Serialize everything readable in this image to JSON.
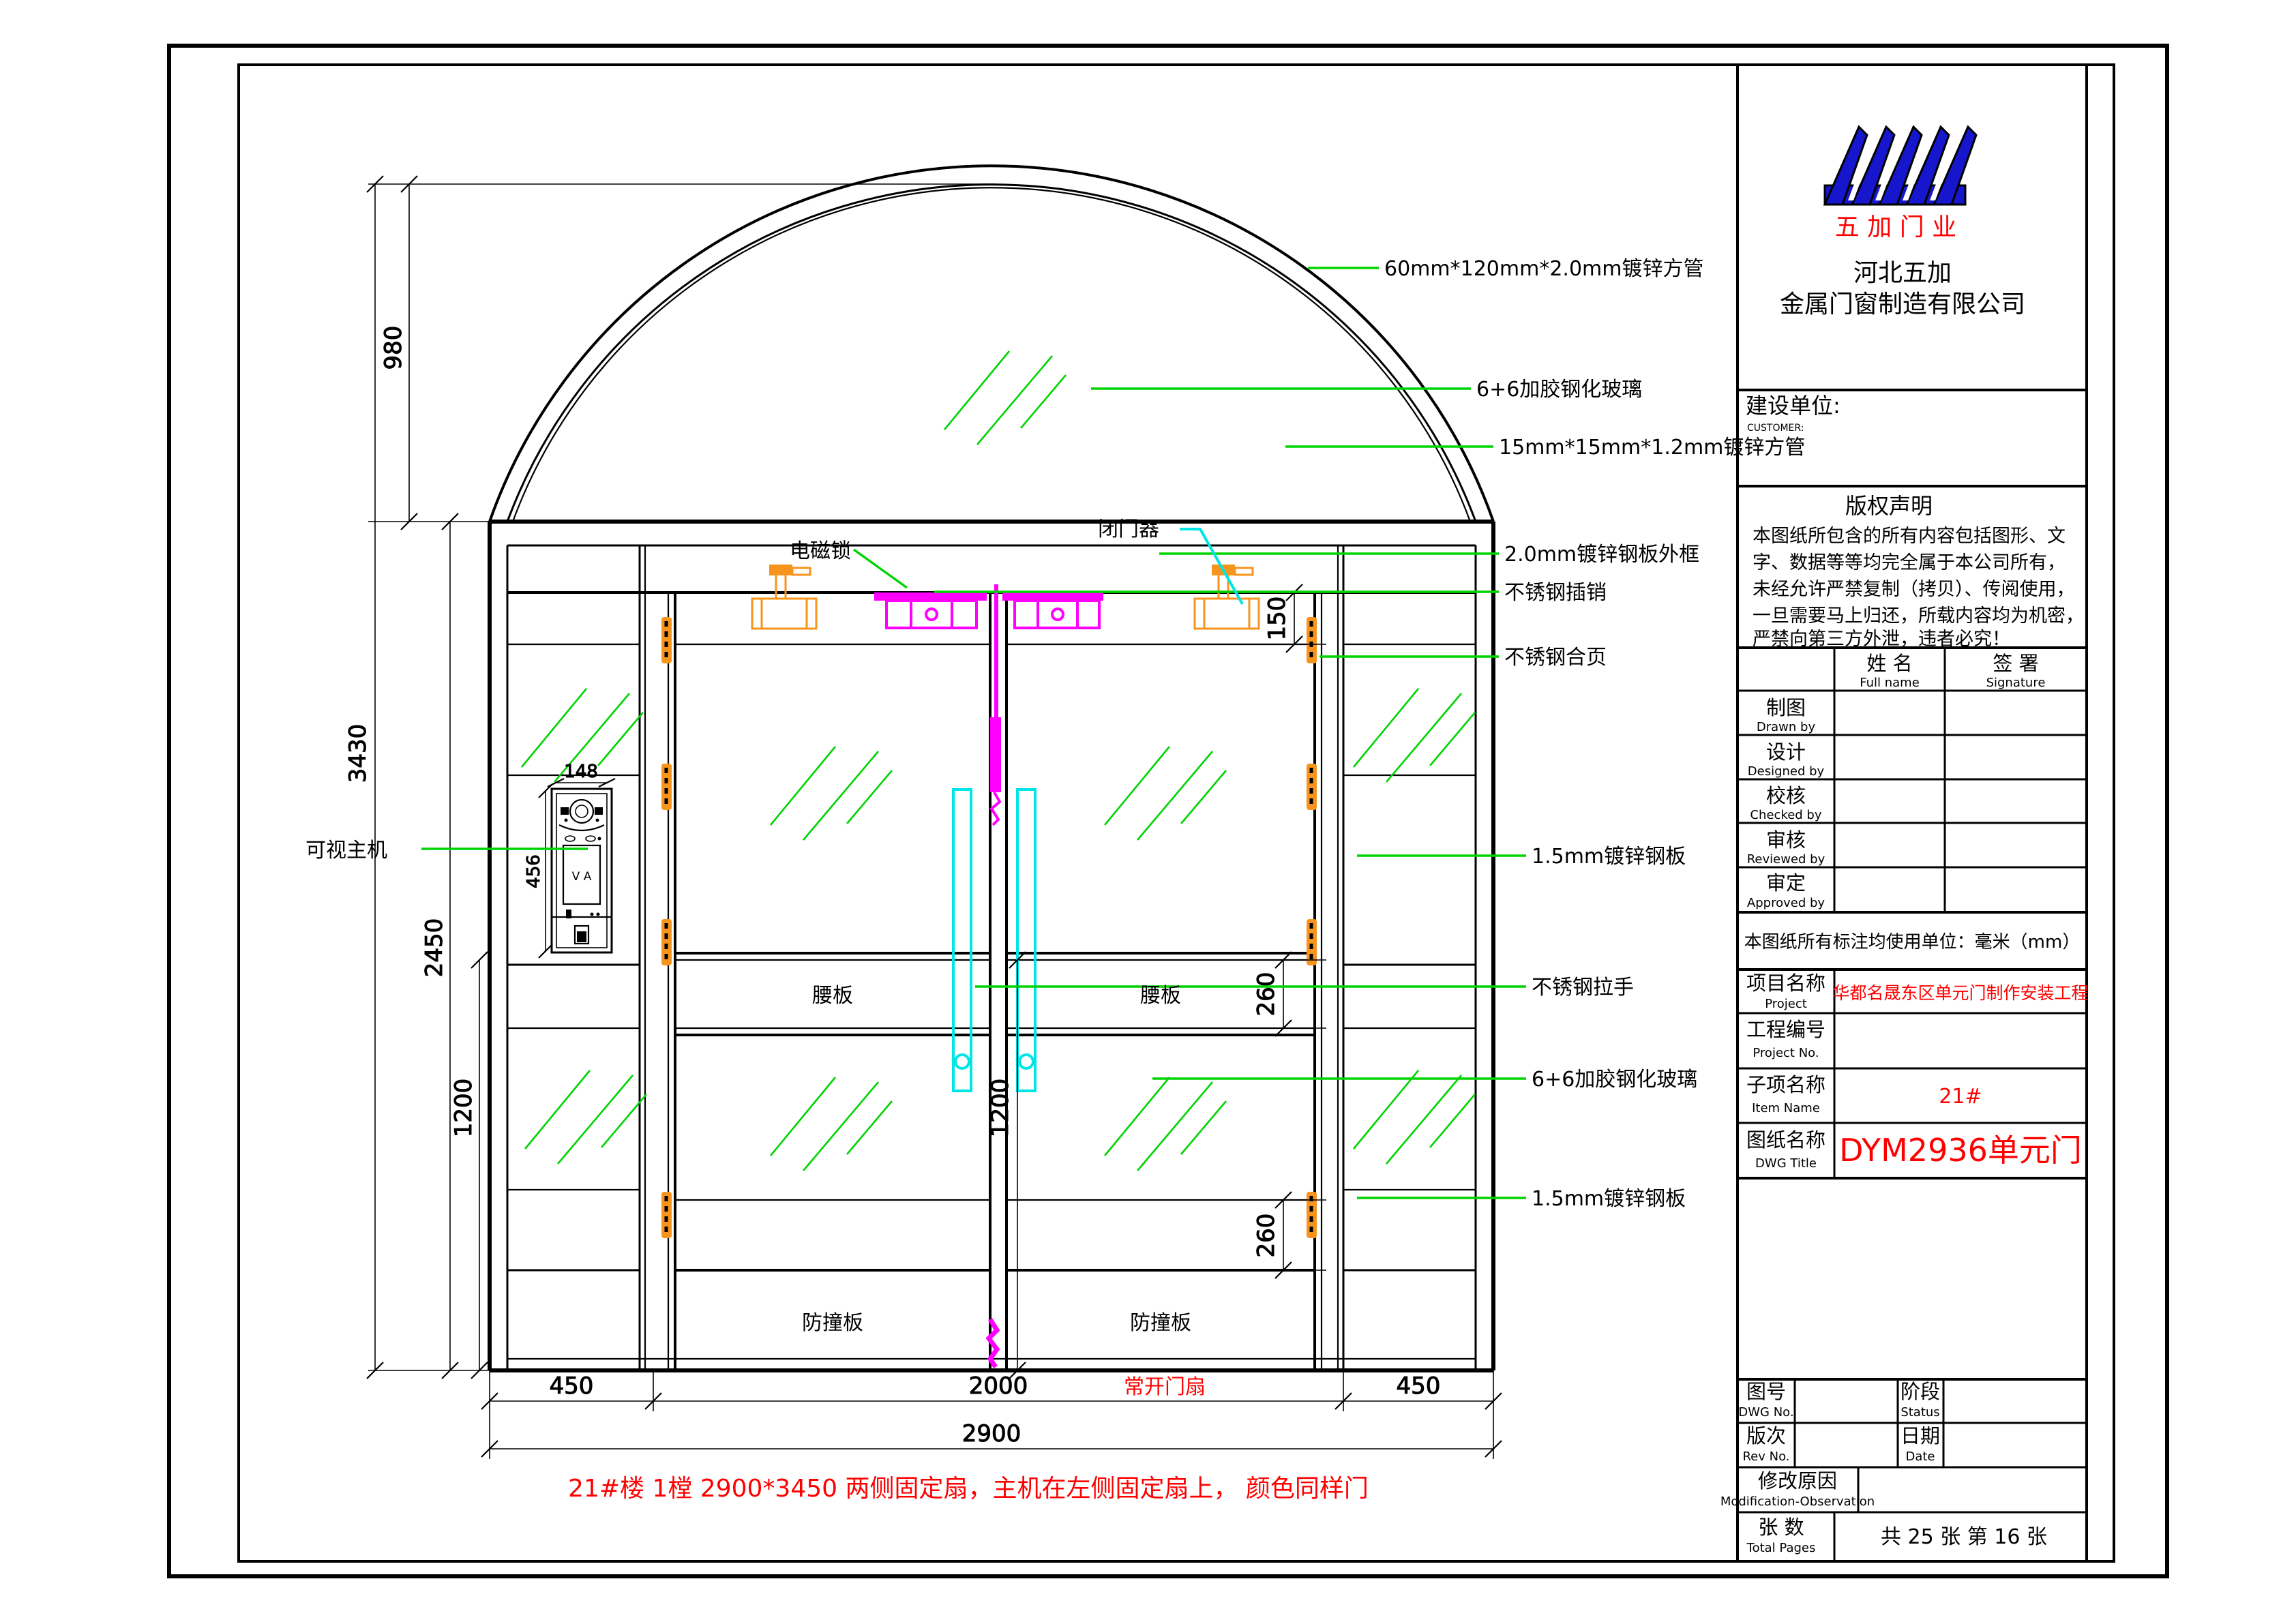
{
  "logo": {
    "brand_text": "五 加 门 业",
    "company_line1": "河北五加",
    "company_line2": "金属门窗制造有限公司",
    "brand_color": "#ff0000",
    "logo_color": "#1616cc"
  },
  "title_block": {
    "customer_label": "建设单位:",
    "customer_sub": "CUSTOMER:",
    "copyright_title": "版权声明",
    "copyright_lines": [
      "本图纸所包含的所有内容包括图形、文",
      "字、数据等等均完全属于本公司所有，",
      "未经允许严禁复制（拷贝）、传阅使用，",
      "一旦需要马上归还，所载内容均为机密，",
      "严禁向第三方外泄，违者必究！"
    ],
    "col_fullname": "姓  名",
    "col_fullname_sub": "Full name",
    "col_signature": "签  署",
    "col_signature_sub": "Signature",
    "sign_rows": [
      {
        "label": "制图",
        "sub": "Drawn by"
      },
      {
        "label": "设计",
        "sub": "Designed by"
      },
      {
        "label": "校核",
        "sub": "Checked by"
      },
      {
        "label": "审核",
        "sub": "Reviewed by"
      },
      {
        "label": "审定",
        "sub": "Approved by"
      }
    ],
    "unit_note": "本图纸所有标注均使用单位：毫米（mm）",
    "project_label": "项目名称",
    "project_sub": "Project",
    "project_value": "华都名晟东区单元门制作安装工程",
    "project_no_label": "工程编号",
    "project_no_sub": "Project No.",
    "project_no_value": "",
    "item_label": "子项名称",
    "item_sub": "Item Name",
    "item_value": "21#",
    "dwg_title_label": "图纸名称",
    "dwg_title_sub": "DWG Title",
    "dwg_title_value": "DYM2936单元门",
    "dwg_no_label": "图号",
    "dwg_no_sub": "DWG No.",
    "dwg_no_value": "",
    "status_label": "阶段",
    "status_sub": "Status",
    "status_value": "",
    "rev_label": "版次",
    "rev_sub": "Rev No.",
    "rev_value": "",
    "date_label": "日期",
    "date_sub": "Date",
    "date_value": "",
    "mod_label": "修改原因",
    "mod_sub": "Modification-Observation",
    "mod_value": "",
    "pages_label": "张    数",
    "pages_sub": "Total Pages",
    "pages_value": "共 25 张 第 16 张",
    "value_color": "#ff0000"
  },
  "callouts": [
    {
      "text": "60mm*120mm*2.0mm镀锌方管"
    },
    {
      "text": "6+6加胶钢化玻璃"
    },
    {
      "text": "15mm*15mm*1.2mm镀锌方管"
    },
    {
      "text": "2.0mm镀锌钢板外框"
    },
    {
      "text": "不锈钢插销"
    },
    {
      "text": "不锈钢合页"
    },
    {
      "text": "1.5mm镀锌钢板"
    },
    {
      "text": "不锈钢拉手"
    },
    {
      "text": "6+6加胶钢化玻璃"
    },
    {
      "text": "1.5mm镀锌钢板"
    }
  ],
  "labels": {
    "door_closer": "闭门器",
    "maglock": "电磁锁",
    "intercom": "可视主机",
    "waist_panel": "腰板",
    "bump_panel": "防撞板",
    "open_leaf": "常开门扇",
    "intercom_screen": "V A"
  },
  "dimensions": {
    "total_height": "3430",
    "arch_height": "980",
    "door_height": "2450",
    "top_rail": "150",
    "waist_band": "260",
    "kick_band": "260",
    "glass_left": "1200",
    "glass_center": "1200",
    "intercom_width": "148",
    "intercom_height": "456",
    "left_fixed": "450",
    "door_opening": "2000",
    "right_fixed": "450",
    "overall_width": "2900"
  },
  "note": "21#楼  1樘  2900*3450    两侧固定扇，主机在左侧固定扇上，    颜色同样门",
  "colors": {
    "leader_green": "#00d400",
    "handle_cyan": "#00e5e5",
    "lock_magenta": "#ff00ff",
    "hardware_orange": "#f7941d",
    "note_red": "#ff0000"
  }
}
